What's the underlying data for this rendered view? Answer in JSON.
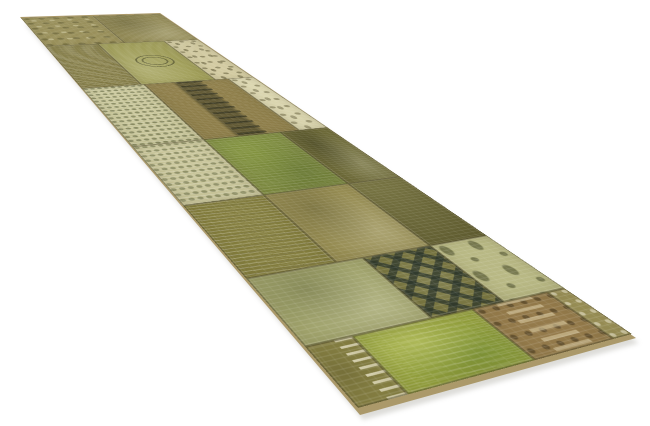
{
  "meta": {
    "subject": "Product photo of a vintage overdyed patchwork runner rug",
    "background_color": "#ffffff",
    "view": "angled perspective, far end upper-left, near end lower-right"
  },
  "rug": {
    "description": "green/olive overdyed patchwork runner composed of rectangular carpet fragments with faded oriental motifs",
    "palette": {
      "olive": "#8e854d",
      "khaki": "#9c9257",
      "yellow_green": "#9e9c55",
      "grass": "#7e8d41",
      "lime": "#9aa93f",
      "sage": "#a9ad75",
      "celadon": "#c3c48f",
      "cream": "#d2caa0",
      "pale": "#dcd7b1",
      "tan": "#9b7f4f",
      "dark_olive": "#6f6c3a",
      "seam": "#3c3a1e",
      "edge_binding": "#ab996a",
      "shadow": "#aaa9a0"
    },
    "quad": {
      "far_left": [
        21,
        18
      ],
      "far_right": [
        160,
        14
      ],
      "near_right": [
        632,
        334
      ],
      "near_bottom": [
        358,
        408
      ]
    },
    "surface_size": [
      760,
      190
    ],
    "matrix3d": "matrix3d(0.150513,0.179343,0,-0.00081818,0.794699,-0.0155296,0,0.0003945,0,0,1,0,21,18,0,1)",
    "edge_quad": [
      [
        20,
        17
      ],
      [
        160,
        13
      ],
      [
        636,
        338
      ],
      [
        360,
        415
      ]
    ],
    "shadow_quad": [
      [
        25,
        24
      ],
      [
        162,
        18
      ],
      [
        639,
        343
      ],
      [
        363,
        420
      ]
    ],
    "patches": [
      {
        "x": 0,
        "y": 0,
        "w": 130,
        "h": 95,
        "color": "#968c52",
        "pattern": "dapple",
        "accent": "rgba(90,85,40,.60)"
      },
      {
        "x": 0,
        "y": 95,
        "w": 130,
        "h": 95,
        "color": "#8e854d",
        "pattern": "mottle",
        "accent": "rgba(75,70,32,.38)"
      },
      {
        "x": 130,
        "y": 0,
        "w": 150,
        "h": 62,
        "color": "#837b44",
        "pattern": "streaks",
        "accent": "rgba(100,95,50,.50)"
      },
      {
        "x": 130,
        "y": 62,
        "w": 150,
        "h": 83,
        "color": "#9e9c55",
        "pattern": "medallion",
        "accent": "rgba(70,70,36,.65)"
      },
      {
        "x": 130,
        "y": 145,
        "w": 150,
        "h": 45,
        "color": "#d2caa0",
        "pattern": "ornate",
        "accent": "rgba(90,85,50,.55)"
      },
      {
        "x": 280,
        "y": 0,
        "w": 150,
        "h": 65,
        "color": "#c8c69a",
        "pattern": "foliage",
        "accent": "rgba(95,100,60,.60)"
      },
      {
        "x": 280,
        "y": 65,
        "w": 150,
        "h": 95,
        "color": "#8f7f4b",
        "pattern": "column",
        "accent": "rgba(60,58,34,.55)"
      },
      {
        "x": 280,
        "y": 160,
        "w": 150,
        "h": 30,
        "color": "#dcd7b1",
        "pattern": "ornate",
        "accent": "rgba(100,95,60,.50)"
      },
      {
        "x": 430,
        "y": 0,
        "w": 110,
        "h": 65,
        "color": "#ccc99e",
        "pattern": "foliage",
        "accent": "rgba(100,105,65,.55)"
      },
      {
        "x": 430,
        "y": 65,
        "w": 110,
        "h": 75,
        "color": "#7e8d41",
        "pattern": "grass",
        "accent": "rgba(60,80,30,.30)"
      },
      {
        "x": 430,
        "y": 140,
        "w": 110,
        "h": 50,
        "color": "#6f6c3a",
        "pattern": "mottle",
        "accent": "rgba(45,45,22,.40)"
      },
      {
        "x": 540,
        "y": 0,
        "w": 100,
        "h": 65,
        "color": "#86803f",
        "pattern": "streaks",
        "accent": "rgba(105,100,50,.50)"
      },
      {
        "x": 540,
        "y": 65,
        "w": 100,
        "h": 75,
        "color": "#9c9257",
        "pattern": "mottle",
        "accent": "rgba(80,75,38,.35)"
      },
      {
        "x": 540,
        "y": 140,
        "w": 100,
        "h": 50,
        "color": "#74713c",
        "pattern": "plain",
        "accent": "rgba(50,48,24,.30)"
      },
      {
        "x": 640,
        "y": 0,
        "w": 70,
        "h": 85,
        "color": "#a9ad75",
        "pattern": "mottle",
        "accent": "rgba(85,90,50,.35)"
      },
      {
        "x": 640,
        "y": 85,
        "w": 70,
        "h": 55,
        "color": "#7c7a44",
        "pattern": "zigzag",
        "accent": "rgba(40,52,44,.75)"
      },
      {
        "x": 640,
        "y": 140,
        "w": 70,
        "h": 50,
        "color": "#c3c48f",
        "pattern": "floral",
        "accent": "rgba(75,80,45,.60)"
      },
      {
        "x": 710,
        "y": 0,
        "w": 50,
        "h": 30,
        "color": "#8c8647",
        "pattern": "inscription",
        "accent": "rgba(240,235,205,.85)"
      },
      {
        "x": 710,
        "y": 30,
        "w": 50,
        "h": 85,
        "color": "#9aa93f",
        "pattern": "lime",
        "accent": "rgba(75,115,40,.33)"
      },
      {
        "x": 710,
        "y": 115,
        "w": 50,
        "h": 60,
        "color": "#9b7f4f",
        "pattern": "tanOrnate",
        "accent": "rgba(55,42,22,.50)"
      },
      {
        "x": 710,
        "y": 175,
        "w": 50,
        "h": 15,
        "color": "#a2985d",
        "pattern": "dots",
        "accent": "rgba(240,235,205,.75)"
      }
    ]
  }
}
